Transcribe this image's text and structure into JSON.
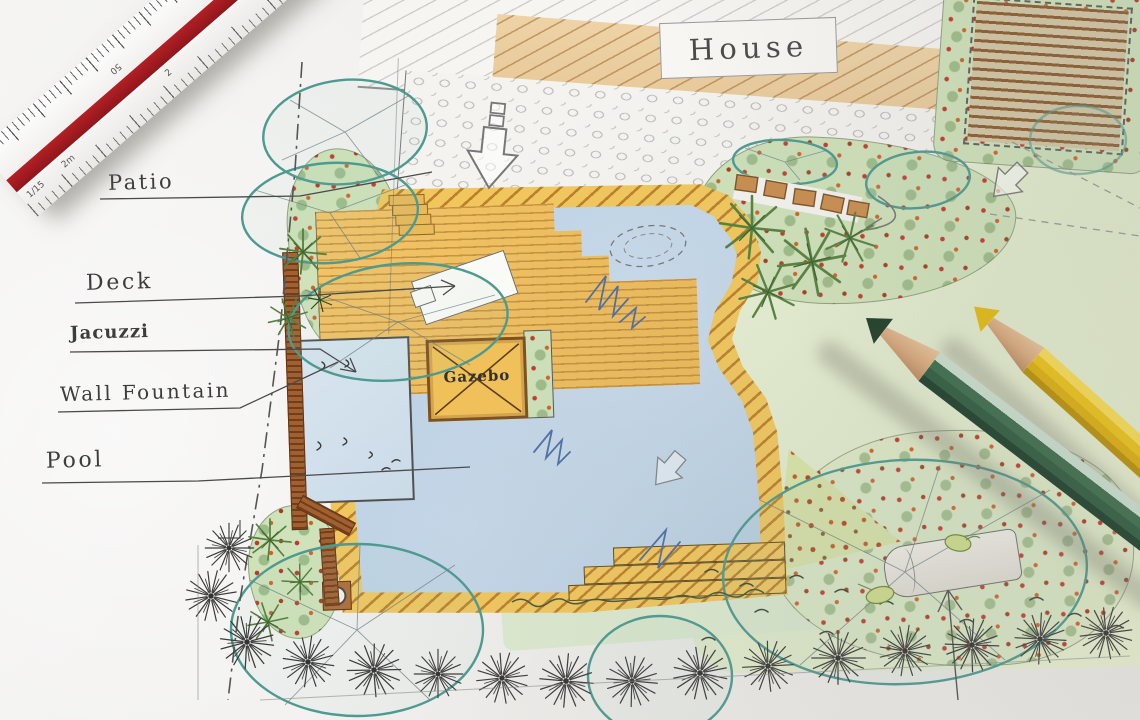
{
  "plan": {
    "labels": {
      "house": "House",
      "patio": "Patio",
      "deck": "Deck",
      "jacuzzi": "Jacuzzi",
      "wall_fountain": "Wall Fountain",
      "pool": "Pool",
      "gazebo": "Gazebo"
    }
  },
  "ruler": {
    "scale_label": "1/15",
    "unit_label": "2m",
    "upper_marks": [
      "50",
      "30"
    ],
    "end_marks": [
      "75",
      "0"
    ],
    "lower_marks": [
      "2",
      "3"
    ]
  },
  "colors": {
    "paper": "#efeeec",
    "pool_water": "#bad0e4",
    "coping_yellow": "#f1c75d",
    "deck_plank": "#f2c468",
    "lawn_green": "#e4edcf",
    "bed_green": "#cfe2ba",
    "tree_outline_teal": "#4c9a90",
    "wall_brown": "#a26030",
    "ruler_stripe_red": "#a31b20",
    "pencil_green": "#2c5a3d",
    "pencil_yellow": "#ecc216",
    "label_ink": "#3d3d3d"
  }
}
